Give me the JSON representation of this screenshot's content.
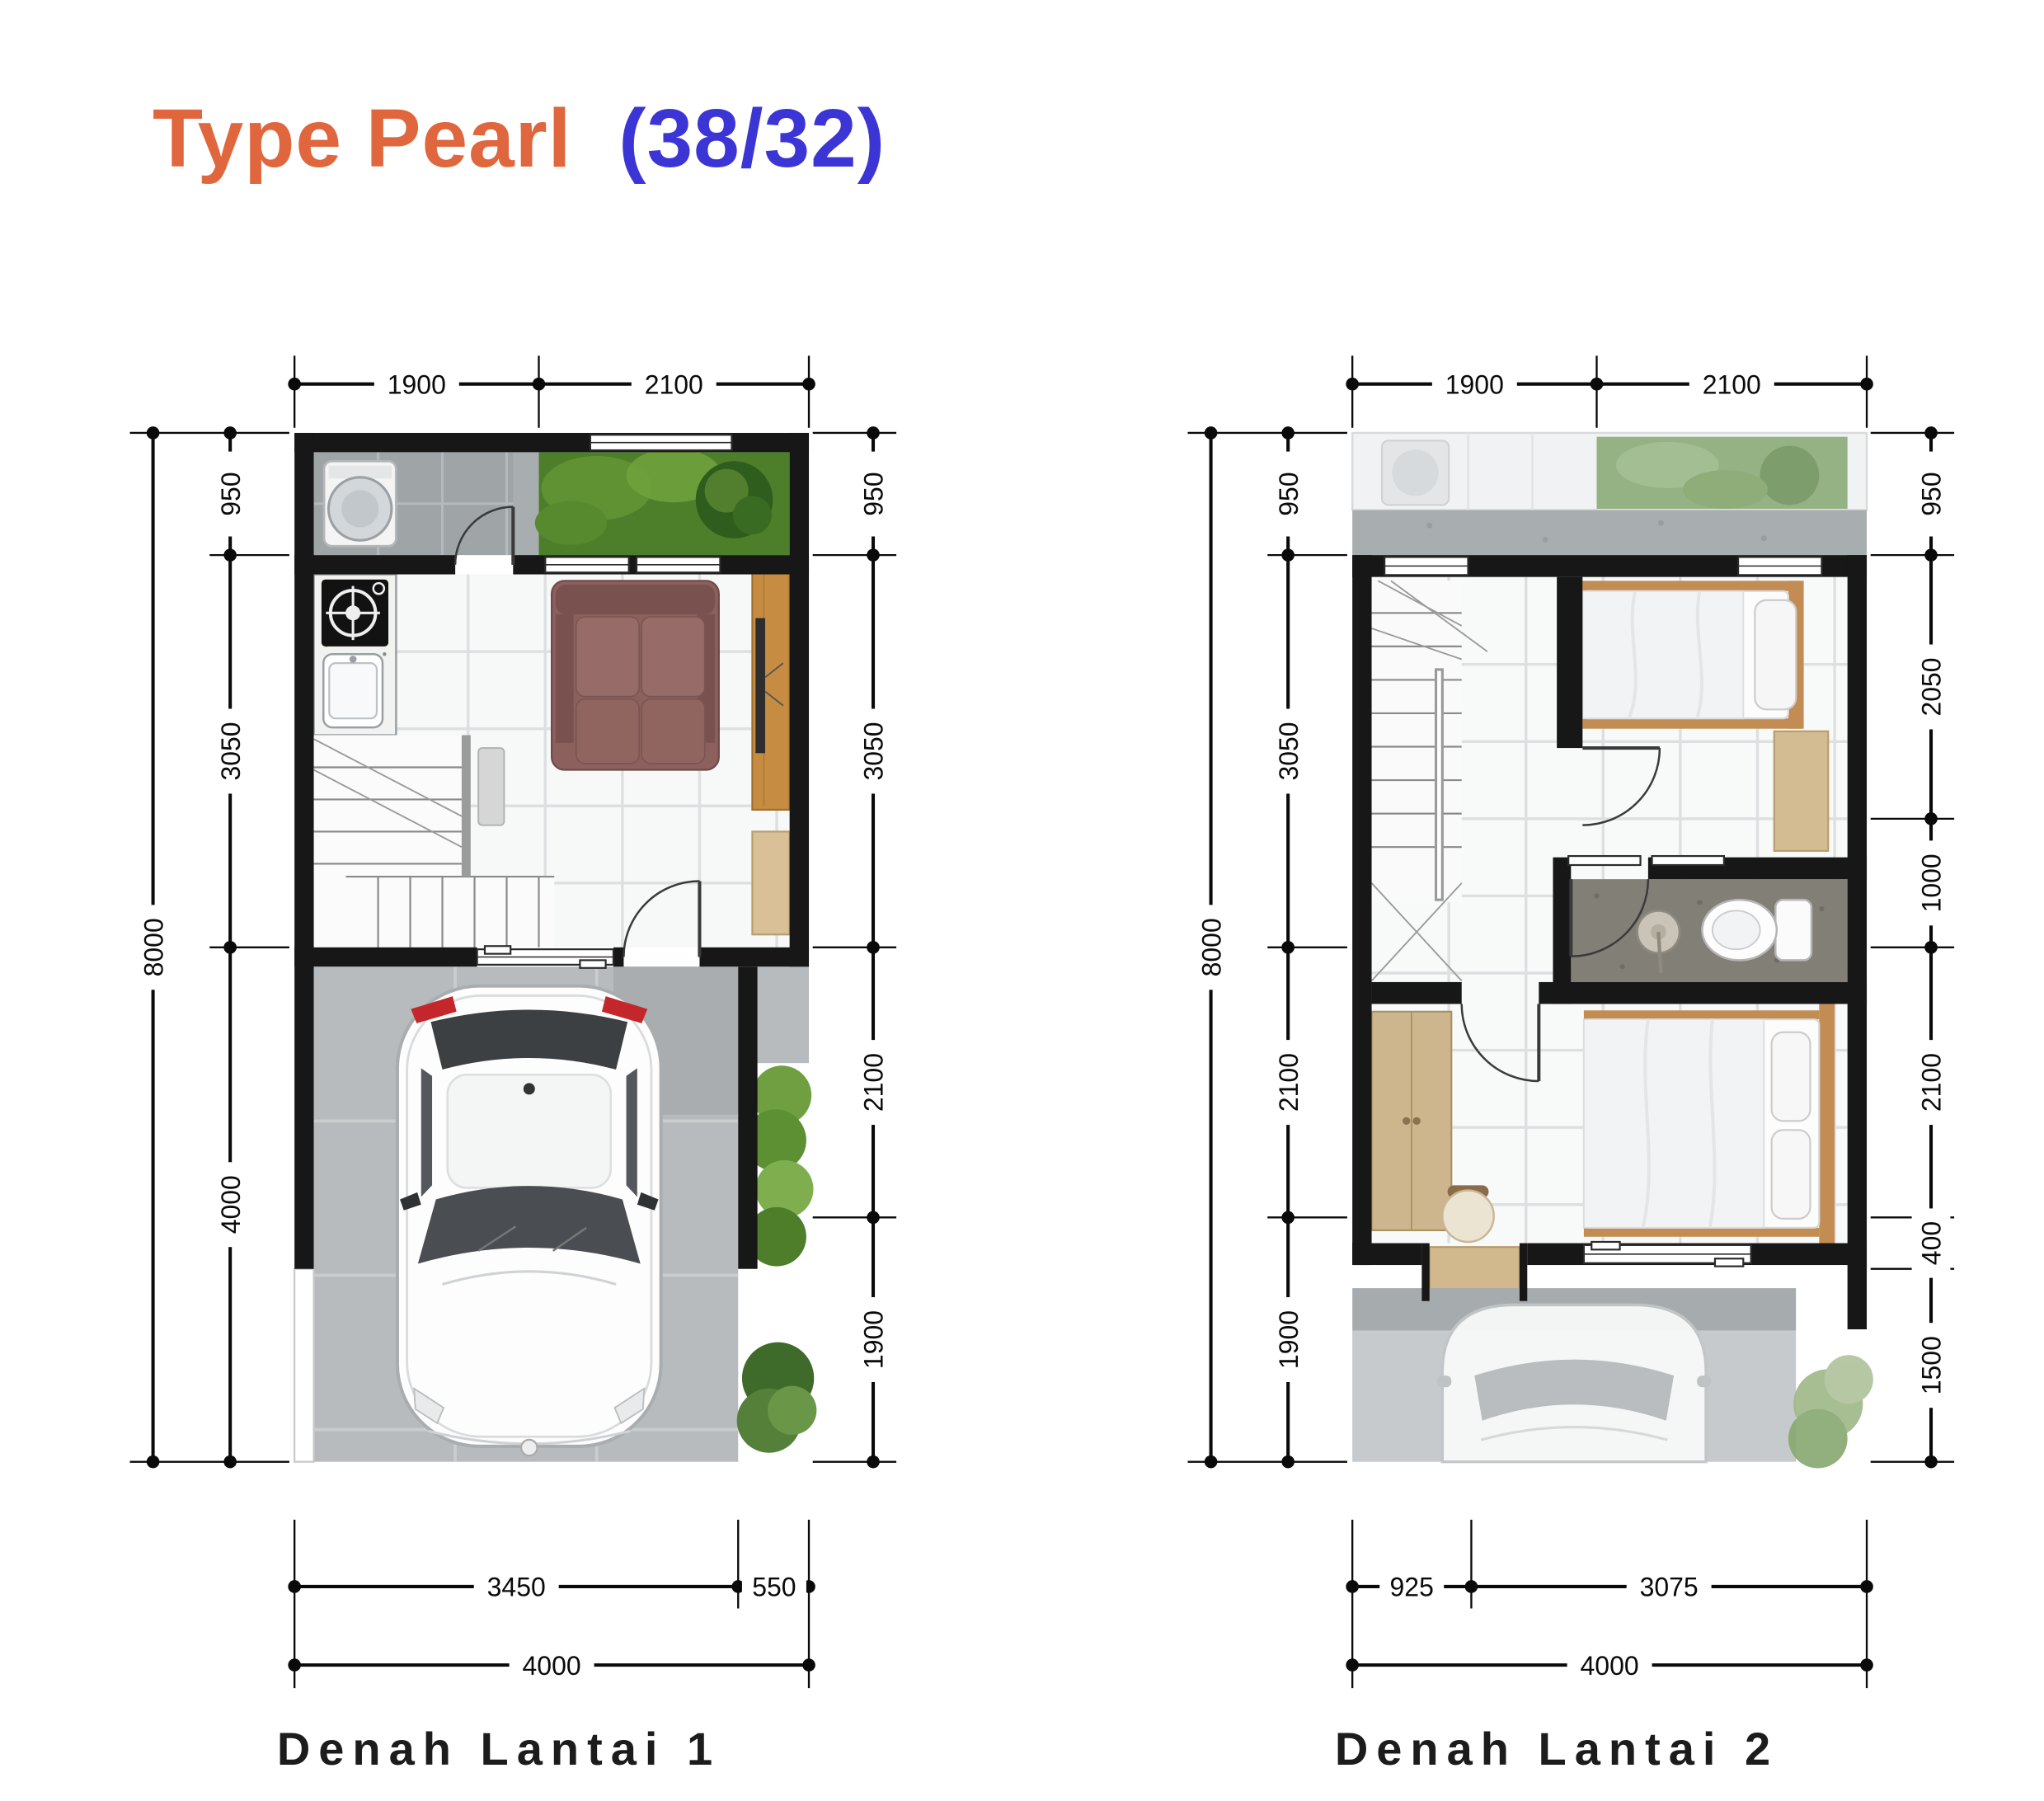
{
  "title": {
    "main": "Type Pearl",
    "suffix": "(38/32)"
  },
  "colors": {
    "title-main": "#e0663d",
    "title-suffix": "#3c35d6",
    "caption": "#1c1c1c",
    "dimension": "#0a0a0a",
    "wall": "#171717",
    "grass": "#4d7f2a",
    "sofa": "#8b605d",
    "wood": "#c68c42",
    "carport": "#b7bbbd"
  },
  "plans": {
    "plan1": {
      "caption": "Denah Lantai 1",
      "dims": {
        "top": [
          "1900",
          "2100"
        ],
        "left_outer": "8000",
        "left_inner": [
          "950",
          "3050",
          "4000"
        ],
        "right": [
          "950",
          "3050",
          "2100",
          "1900"
        ],
        "bottom_inner": [
          "3450",
          "550"
        ],
        "bottom_outer": "4000"
      }
    },
    "plan2": {
      "caption": "Denah Lantai 2",
      "dims": {
        "top": [
          "1900",
          "2100"
        ],
        "left_outer": "8000",
        "left_inner": [
          "950",
          "3050",
          "2100",
          "1900"
        ],
        "right": [
          "950",
          "2050",
          "1000",
          "2100",
          "400",
          "1500"
        ],
        "bottom_inner": [
          "925",
          "3075"
        ],
        "bottom_outer": "4000"
      }
    }
  }
}
